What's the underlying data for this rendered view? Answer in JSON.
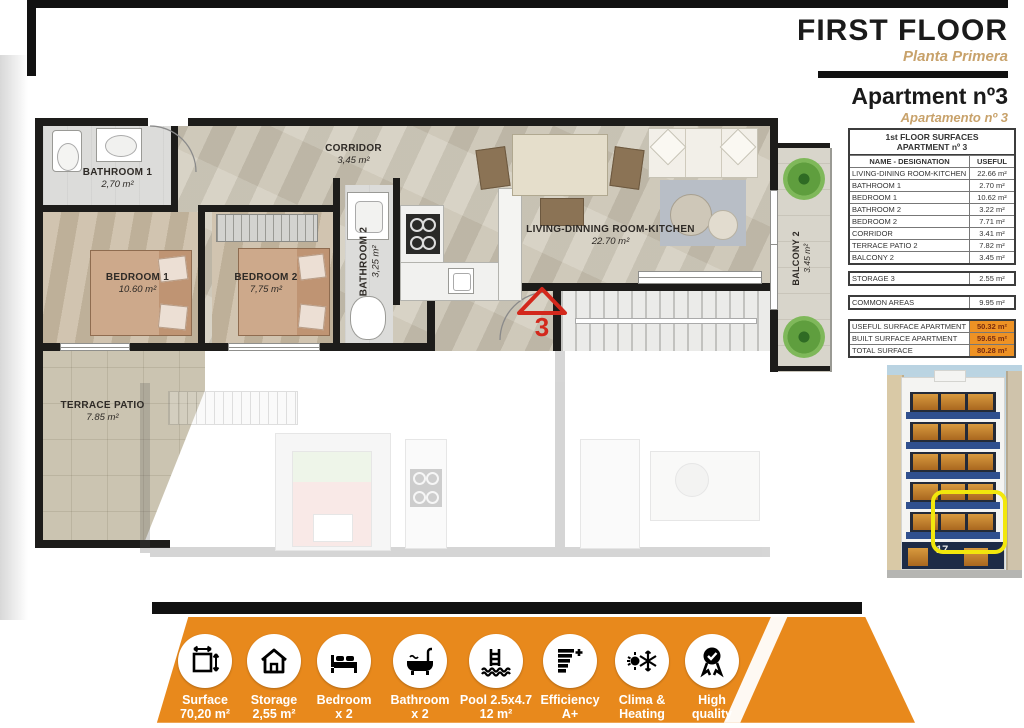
{
  "header": {
    "title": "FIRST FLOOR",
    "subtitle": "Planta Primera",
    "apartment_title": "Apartment nº3",
    "apartment_subtitle": "Apartamento nº 3"
  },
  "surfaces_table": {
    "title_line1": "1st FLOOR SURFACES",
    "title_line2": "APARTMENT nº 3",
    "col_name": "NAME - DESIGNATION",
    "col_useful": "USEFUL",
    "rows": [
      {
        "name": "LIVING-DINING ROOM-KITCHEN",
        "value": "22.66 m²"
      },
      {
        "name": "BATHROOM 1",
        "value": "2.70 m²"
      },
      {
        "name": "BEDROOM 1",
        "value": "10.62 m²"
      },
      {
        "name": "BATHROOM 2",
        "value": "3.22 m²"
      },
      {
        "name": "BEDROOM 2",
        "value": "7.71 m²"
      },
      {
        "name": "CORRIDOR",
        "value": "3.41 m²"
      },
      {
        "name": "TERRACE PATIO 2",
        "value": "7.82 m²"
      },
      {
        "name": "BALCONY 2",
        "value": "3.45 m²"
      }
    ],
    "storage_row": {
      "name": "STORAGE 3",
      "value": "2.55 m²"
    },
    "common_row": {
      "name": "COMMON AREAS",
      "value": "9.95 m²"
    },
    "summary_rows": [
      {
        "name": "USEFUL SURFACE APARTMENT",
        "value": "50.32 m²"
      },
      {
        "name": "BUILT SURFACE APARTMENT",
        "value": "59.65 m²"
      },
      {
        "name": "TOTAL SURFACE",
        "value": "80.28 m²"
      }
    ]
  },
  "plan": {
    "bathroom1": {
      "name": "BATHROOM 1",
      "area": "2,70 m²"
    },
    "bedroom1": {
      "name": "BEDROOM 1",
      "area": "10.60 m²"
    },
    "bedroom2": {
      "name": "BEDROOM 2",
      "area": "7,75 m²"
    },
    "corridor": {
      "name": "CORRIDOR",
      "area": "3,45 m²"
    },
    "bathroom2": {
      "name": "BATHROOM 2",
      "area": "3,25 m²"
    },
    "living": {
      "name": "LIVING-DINNING ROOM-KITCHEN",
      "area": "22.70 m²"
    },
    "terrace": {
      "name": "TERRACE  PATIO",
      "area": "7.85 m²"
    },
    "balcony2": {
      "name": "BALCONY 2",
      "area": "3.45 m²"
    },
    "unit_number": "3"
  },
  "building": {
    "street_number": "17"
  },
  "footer": {
    "items": [
      {
        "line1": "Surface",
        "line2": "70,20 m²",
        "icon": "surface-measure-icon"
      },
      {
        "line1": "Storage",
        "line2": "2,55 m²",
        "icon": "storage-house-icon"
      },
      {
        "line1": "Bedroom",
        "line2": "x 2",
        "icon": "bed-icon"
      },
      {
        "line1": "Bathroom",
        "line2": "x 2",
        "icon": "bathtub-icon"
      },
      {
        "line1": "Pool 2.5x4.7",
        "line2": "12 m²",
        "icon": "pool-ladder-icon"
      },
      {
        "line1": "Efficiency",
        "line2": "A+",
        "icon": "energy-efficiency-icon"
      },
      {
        "line1": "Clima &",
        "line2": "Heating",
        "icon": "climate-icon"
      },
      {
        "line1": "High",
        "line2": "quality",
        "icon": "quality-award-icon"
      }
    ]
  },
  "colors": {
    "accent_orange": "#e8891c",
    "accent_tan": "#c8a26b",
    "highlight_yellow": "#f2e70c",
    "marker_red": "#d3281c",
    "wall_black": "#1d1c1a"
  }
}
